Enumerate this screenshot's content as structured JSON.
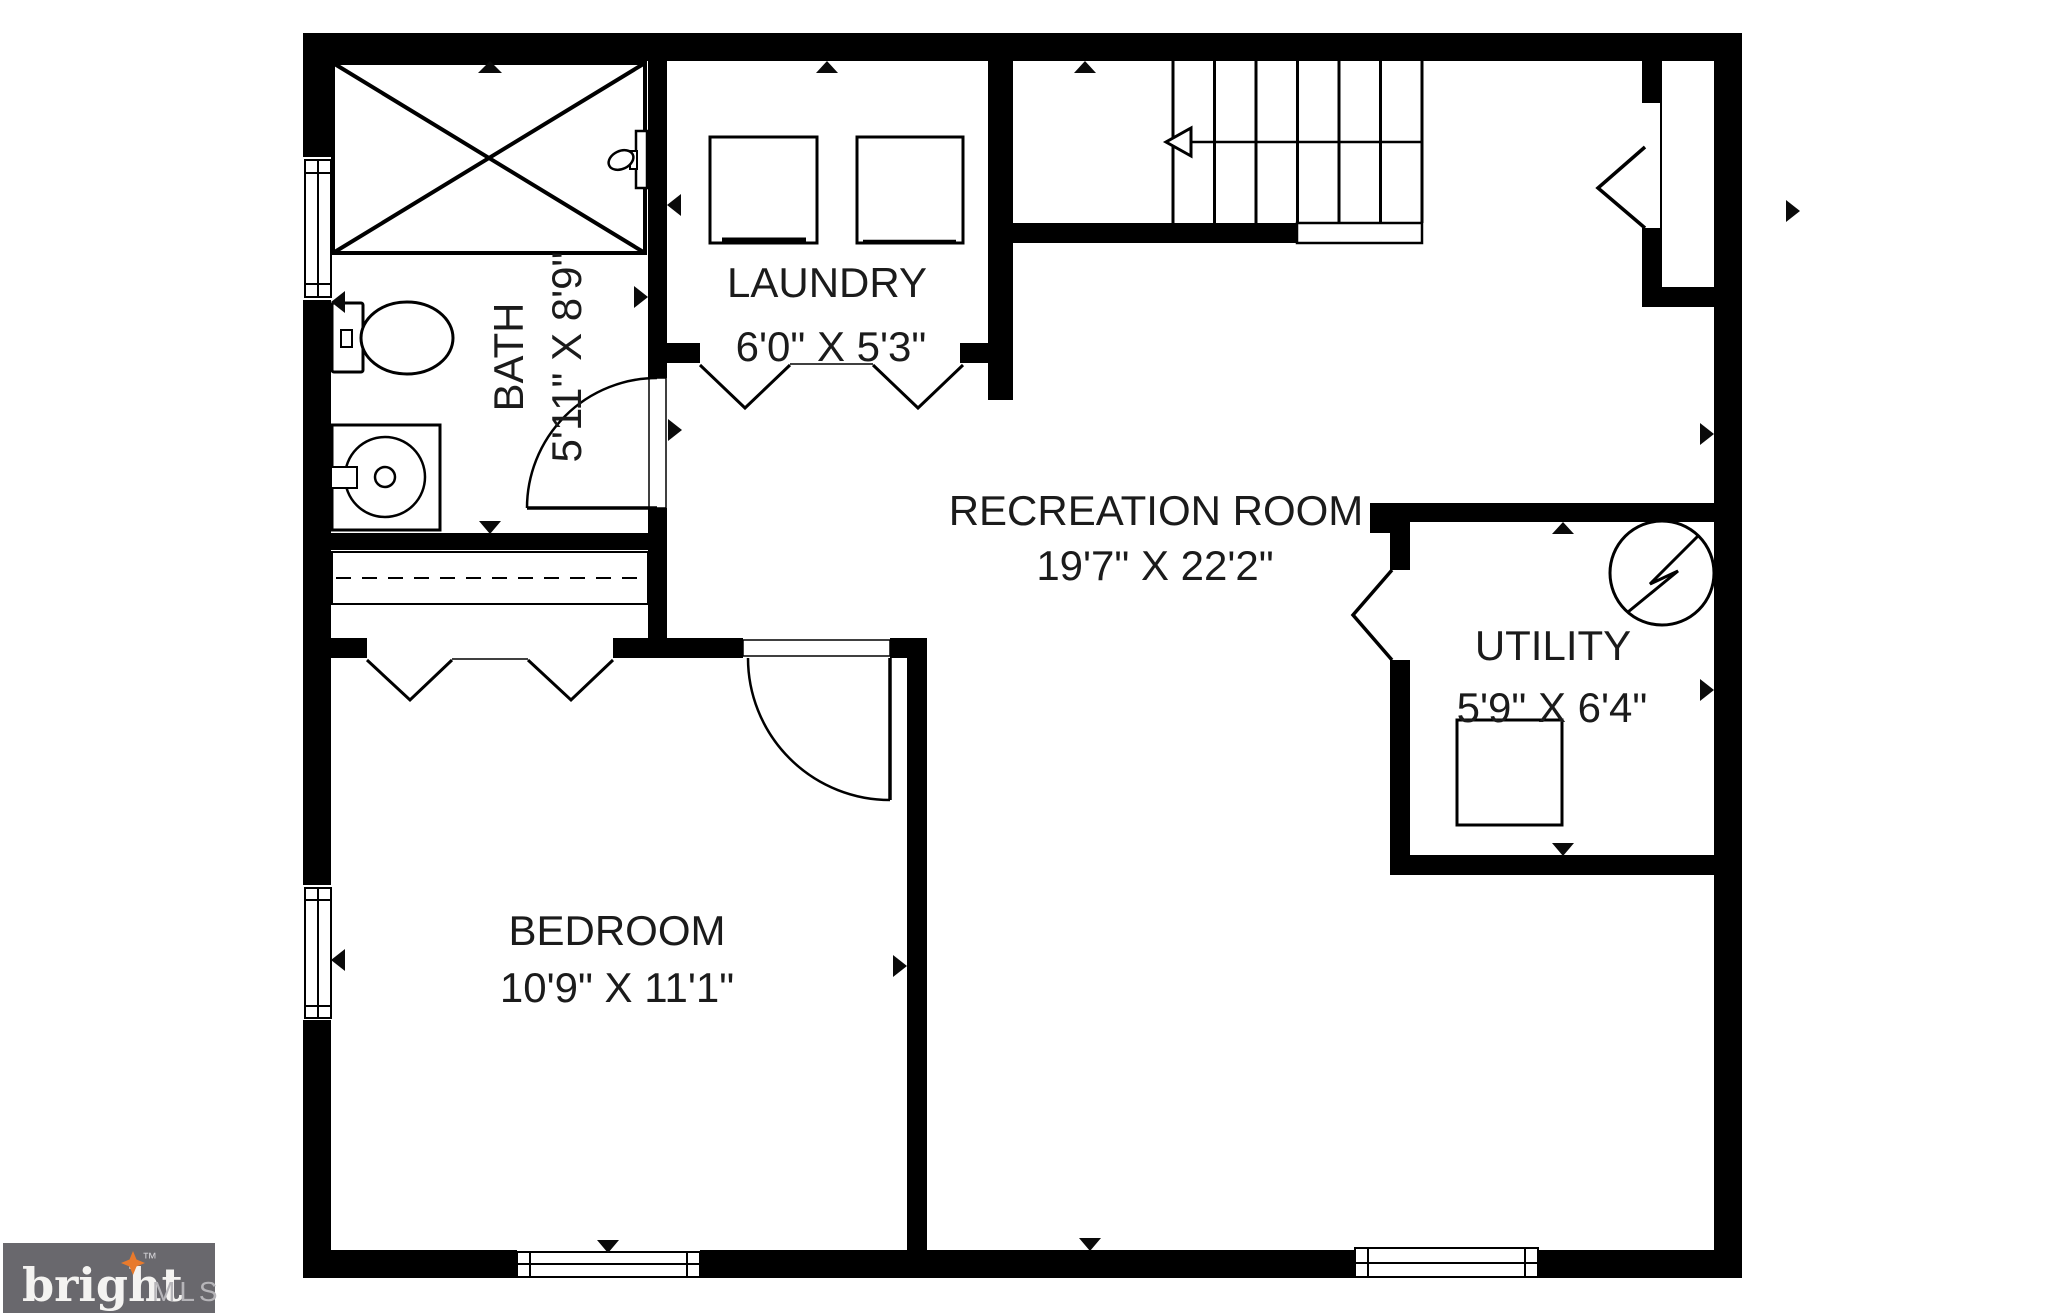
{
  "floorplan": {
    "wall_color": "#000000",
    "label_color": "#1b1b1b",
    "rooms": [
      {
        "id": "bath",
        "label": "BATH",
        "dimensions": "5'11\" X 8'9\""
      },
      {
        "id": "laundry",
        "label": "LAUNDRY",
        "dimensions": "6'0\" X 5'3\""
      },
      {
        "id": "recreation-room",
        "label": "RECREATION ROOM",
        "dimensions": "19'7\" X 22'2\""
      },
      {
        "id": "utility",
        "label": "UTILITY",
        "dimensions": "5'9\" X 6'4\""
      },
      {
        "id": "bedroom",
        "label": "BEDROOM",
        "dimensions": "10'9\" X 11'1\""
      }
    ],
    "fixtures": [
      "shower-icon",
      "toilet-icon",
      "sink-icon",
      "washer-icon",
      "dryer-icon",
      "water-heater-icon",
      "electrical-panel-icon",
      "stairs-icon",
      "window-icon",
      "door-swing-icon",
      "bifold-door-icon",
      "camera-marker-icon"
    ]
  },
  "branding": {
    "logo_word": "bright",
    "logo_tm": "™",
    "logo_suffix": "MLS",
    "logo_background": "#69686d",
    "logo_word_color": "#f4f3f1",
    "logo_suffix_color": "#b6b5b9",
    "star_color": "#e87a2c"
  }
}
